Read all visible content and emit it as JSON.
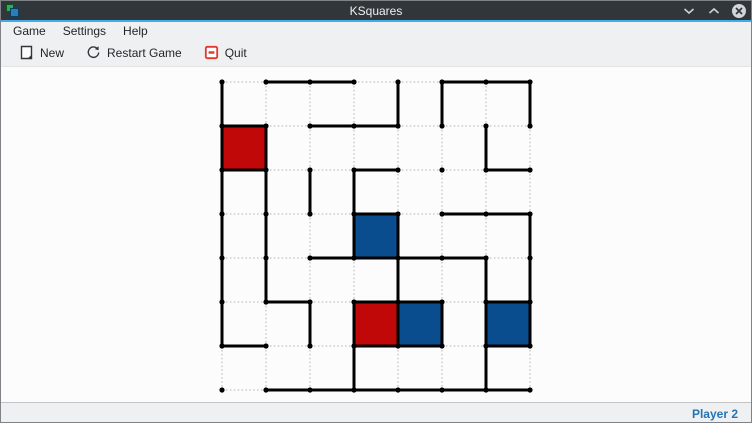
{
  "window": {
    "title": "KSquares",
    "titlebar_bg": "#31363b",
    "accent_color": "#3daee9",
    "controls": [
      {
        "name": "minimize",
        "icon": "chevron-down-icon"
      },
      {
        "name": "maximize",
        "icon": "chevron-up-icon"
      },
      {
        "name": "close",
        "icon": "circle-x-icon"
      }
    ]
  },
  "menubar": {
    "items": [
      "Game",
      "Settings",
      "Help"
    ]
  },
  "toolbar": {
    "buttons": [
      {
        "label": "New",
        "icon": "new-document-icon"
      },
      {
        "label": "Restart Game",
        "icon": "restart-icon"
      },
      {
        "label": "Quit",
        "icon": "quit-icon",
        "icon_color": "#e0382d"
      }
    ]
  },
  "statusbar": {
    "player_turn": "Player 2",
    "text_color": "#2474b5"
  },
  "board": {
    "dot_cols": 8,
    "dot_rows": 8,
    "origin_x": 221,
    "origin_y": 15,
    "spacing": 44,
    "dot_color": "#000000",
    "dot_radius": 2.6,
    "drawn_color": "#010101",
    "drawn_width": 3,
    "undrawn_color": "#c4c4c4",
    "undrawn_width": 1.3,
    "player_colors": {
      "red": "#c00808",
      "blue": "#0a4d8f"
    },
    "h_edges": [
      [
        0,
        1,
        1,
        0,
        0,
        1,
        1
      ],
      [
        1,
        0,
        1,
        1,
        0,
        0,
        0
      ],
      [
        1,
        0,
        0,
        1,
        0,
        0,
        1
      ],
      [
        0,
        0,
        0,
        1,
        0,
        1,
        1
      ],
      [
        0,
        0,
        1,
        1,
        1,
        1,
        0
      ],
      [
        0,
        1,
        0,
        1,
        1,
        0,
        1
      ],
      [
        1,
        0,
        0,
        1,
        1,
        0,
        1
      ],
      [
        0,
        1,
        1,
        1,
        1,
        1,
        1
      ]
    ],
    "v_edges": [
      [
        1,
        0,
        0,
        0,
        1,
        1,
        0,
        1
      ],
      [
        1,
        1,
        0,
        0,
        0,
        0,
        1,
        0
      ],
      [
        1,
        1,
        1,
        1,
        0,
        0,
        0,
        0
      ],
      [
        1,
        1,
        0,
        1,
        1,
        0,
        0,
        1
      ],
      [
        1,
        1,
        0,
        0,
        1,
        0,
        1,
        1
      ],
      [
        1,
        0,
        1,
        1,
        1,
        1,
        1,
        1
      ],
      [
        0,
        0,
        0,
        1,
        0,
        0,
        1,
        0
      ]
    ],
    "filled_squares": [
      {
        "col": 0,
        "row": 1,
        "owner": "red"
      },
      {
        "col": 3,
        "row": 3,
        "owner": "blue"
      },
      {
        "col": 3,
        "row": 5,
        "owner": "red"
      },
      {
        "col": 4,
        "row": 5,
        "owner": "blue"
      },
      {
        "col": 6,
        "row": 5,
        "owner": "blue"
      }
    ]
  }
}
